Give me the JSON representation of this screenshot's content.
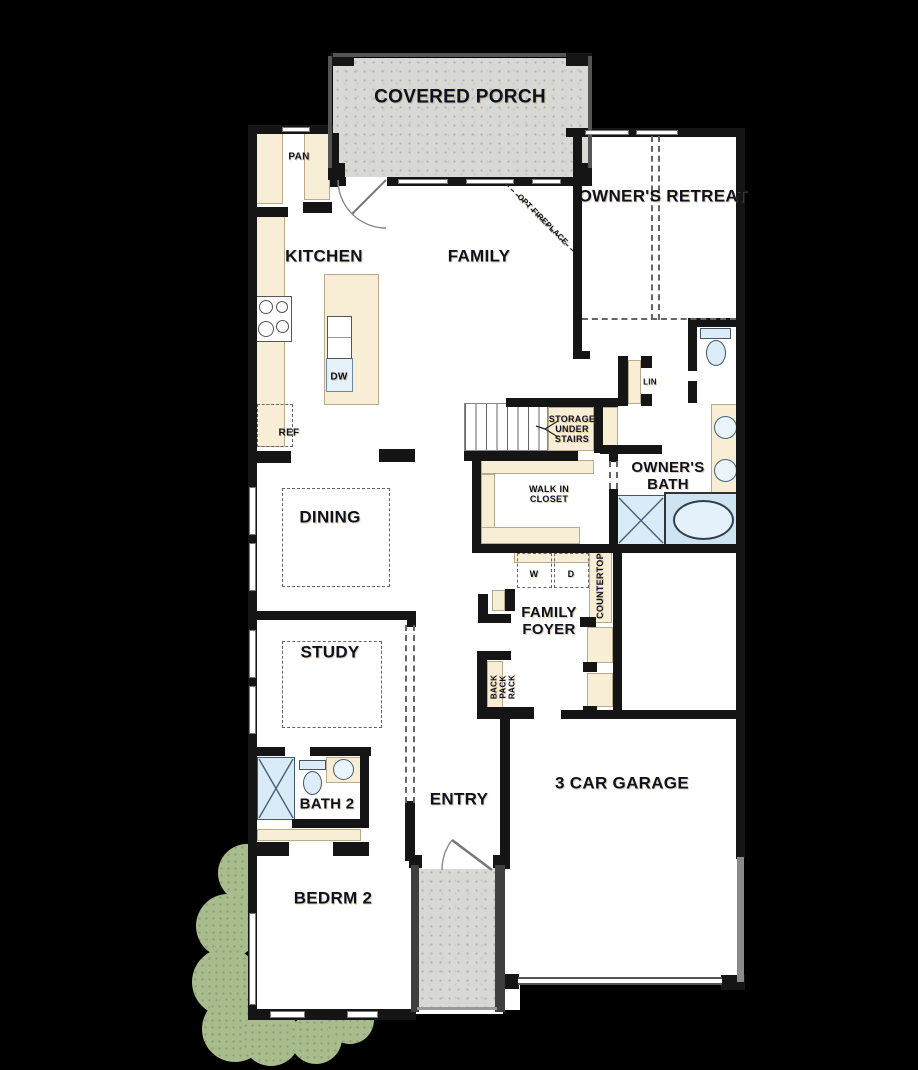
{
  "colors": {
    "wall": "#151515",
    "cream": "#f8eed6",
    "fix": "#d9ebf7",
    "porch": "#d8d8d5",
    "bush": "#a9bc8d",
    "ink": "#0e1220"
  },
  "labels": [
    {
      "id": "covered-porch",
      "text": "COVERED PORCH"
    },
    {
      "id": "pan",
      "text": "PAN"
    },
    {
      "id": "owners-retreat",
      "text": "OWNER'S RETREAT"
    },
    {
      "id": "kitchen",
      "text": "KITCHEN"
    },
    {
      "id": "family",
      "text": "FAMILY"
    },
    {
      "id": "opt-fireplace",
      "text": "OPT FIREPLACE"
    },
    {
      "id": "dw",
      "text": "DW"
    },
    {
      "id": "ref",
      "text": "REF"
    },
    {
      "id": "lin",
      "text": "LIN"
    },
    {
      "id": "storage-under-stairs",
      "text": "STORAGE\nUNDER\nSTAIRS"
    },
    {
      "id": "walk-in-closet",
      "text": "WALK IN\nCLOSET"
    },
    {
      "id": "owners-bath",
      "text": "OWNER'S\nBATH"
    },
    {
      "id": "dining",
      "text": "DINING"
    },
    {
      "id": "washer",
      "text": "W"
    },
    {
      "id": "dryer",
      "text": "D"
    },
    {
      "id": "countertop",
      "text": "COUNTERTOP"
    },
    {
      "id": "family-foyer",
      "text": "FAMILY\nFOYER"
    },
    {
      "id": "study",
      "text": "STUDY"
    },
    {
      "id": "back-pack-rack",
      "text": "BACK\nPACK\nRACK"
    },
    {
      "id": "bath-2",
      "text": "BATH 2"
    },
    {
      "id": "entry",
      "text": "ENTRY"
    },
    {
      "id": "garage",
      "text": "3 CAR GARAGE"
    },
    {
      "id": "bedrm-2",
      "text": "BEDRM 2"
    }
  ],
  "fixtures": [
    "cooktop",
    "kitchen-island",
    "island-sink",
    "dishwasher",
    "refrigerator",
    "pantry-shelves",
    "stairs",
    "storage-under-stairs",
    "linen-closet",
    "owners-toilet",
    "owners-vanity-sinks",
    "owners-shower",
    "owners-tub",
    "washer",
    "dryer",
    "countertop",
    "back-pack-rack",
    "closet-cubbies",
    "bath2-shower",
    "bath2-toilet",
    "bath2-sink",
    "dining-table",
    "study-desk",
    "porch-door",
    "front-door",
    "garage-door",
    "bushes",
    "opt-fireplace-line"
  ]
}
